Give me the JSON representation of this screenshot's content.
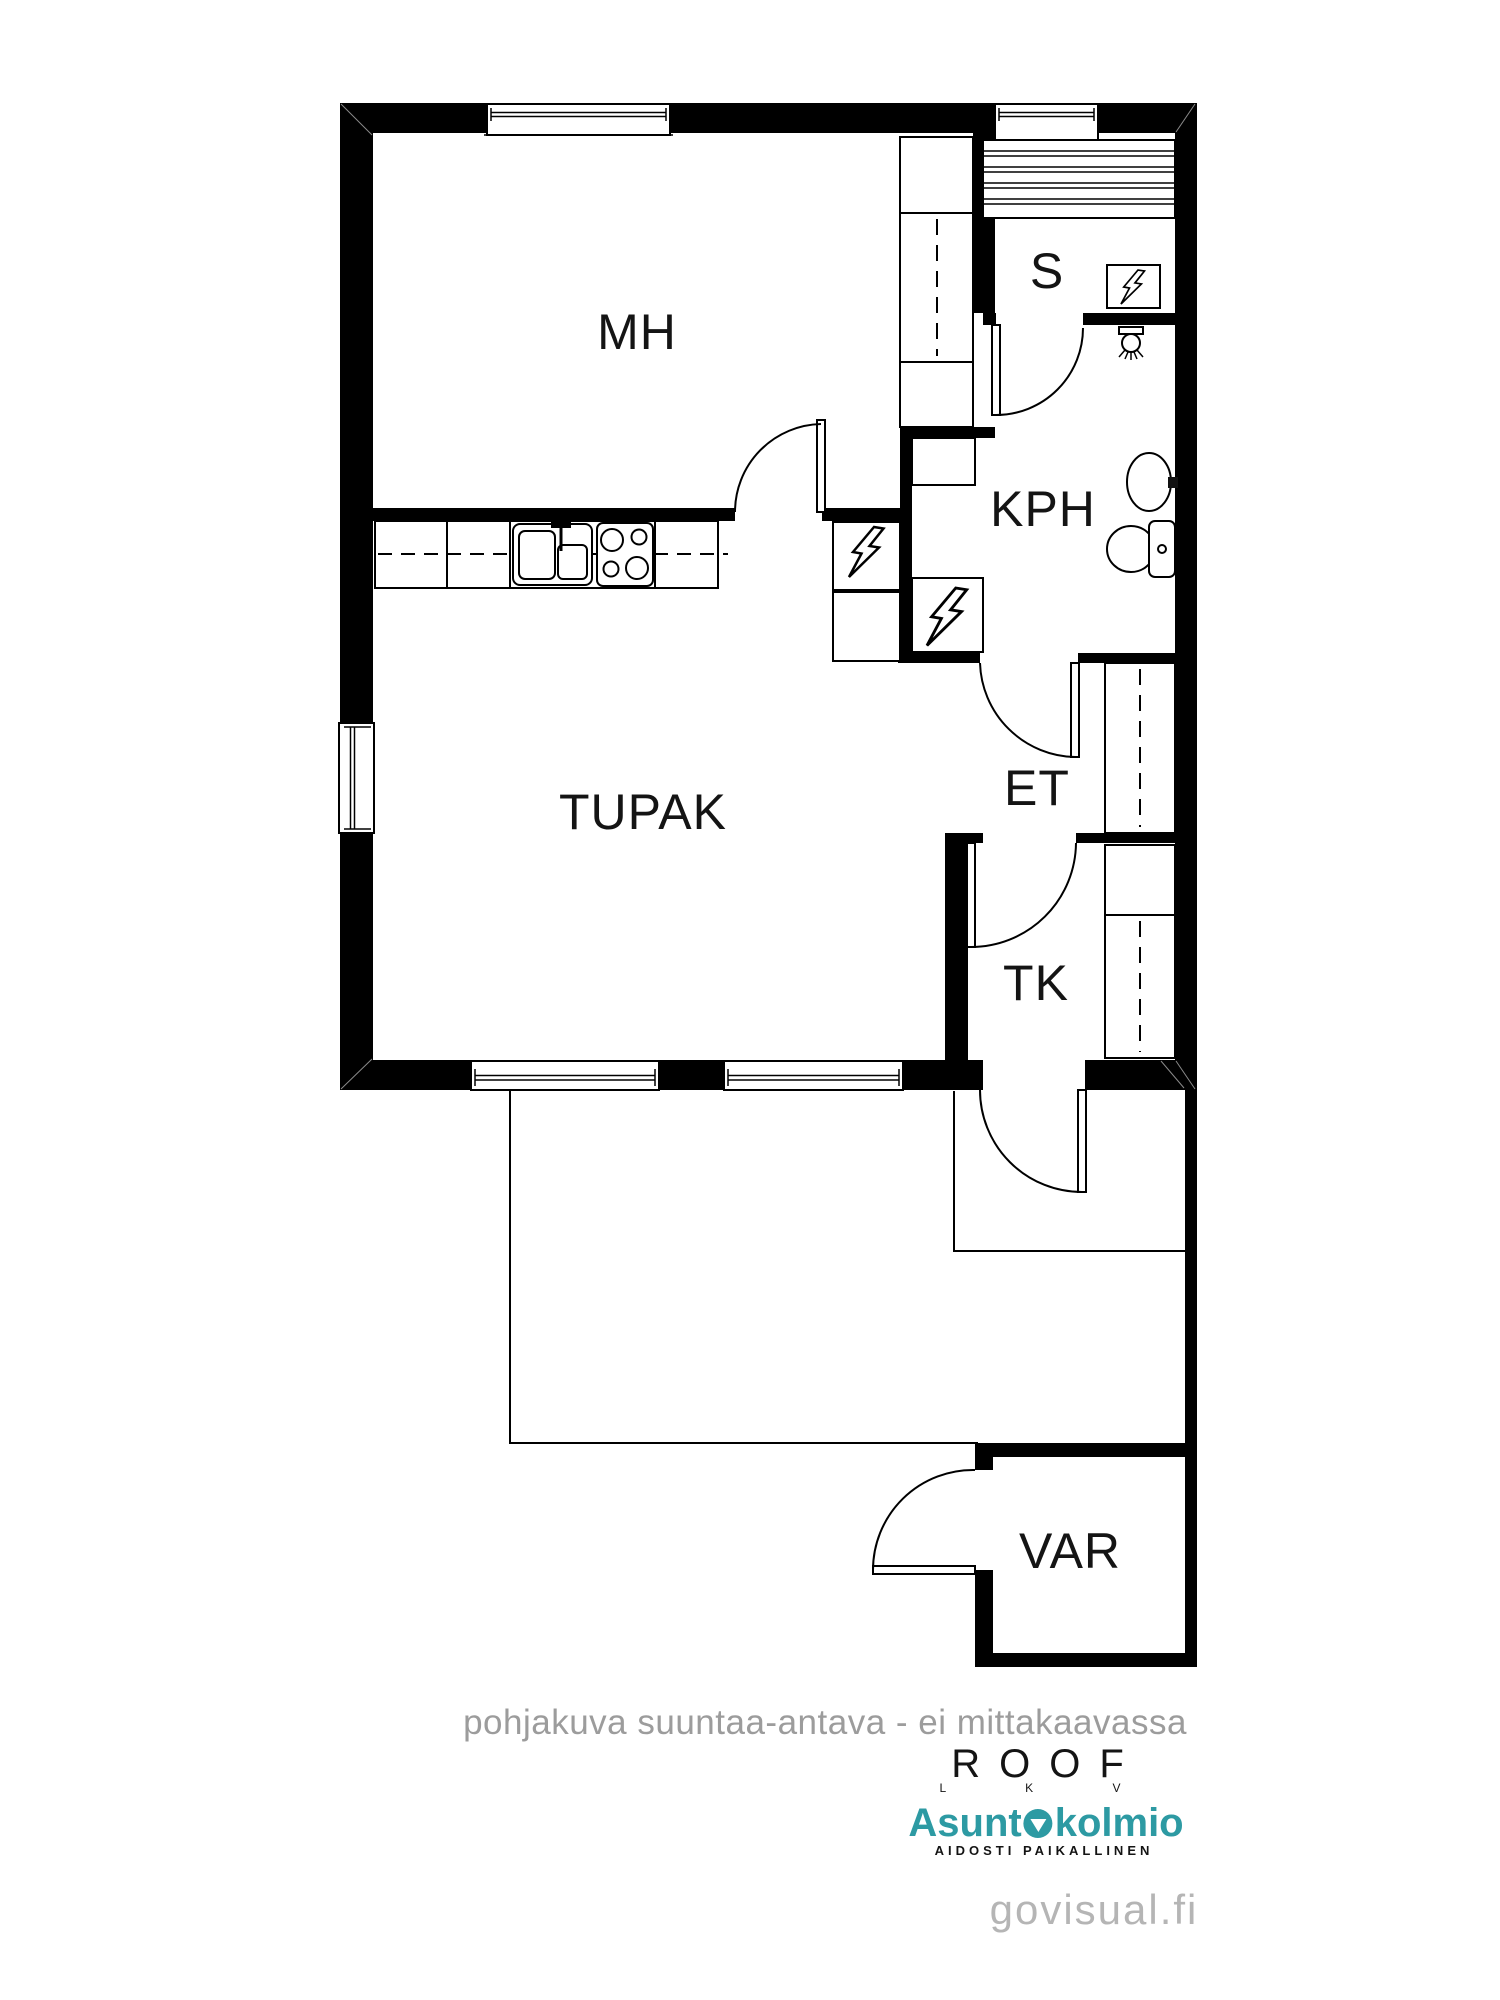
{
  "colors": {
    "wall_black": "#000000",
    "brand_teal": "#2d9aa3",
    "disclaimer_gray": "#9c9c9c",
    "watermark_gray": "#b5b5b5"
  },
  "plan": {
    "rooms": {
      "mh": "MH",
      "tupak": "TUPAK",
      "sauna": "S",
      "kph": "KPH",
      "et": "ET",
      "tk": "TK",
      "var": "VAR"
    },
    "symbols": {
      "electrical_box": "lightning-bolt-in-box",
      "sauna_heater": "lightning-bolt-in-box",
      "shower": "shower-head-with-spray",
      "washbasin": "oval-sink-with-tap",
      "toilet": "wc-bowl-and-cistern",
      "kitchen_sink": "double-basin-sink-with-tap",
      "stove": "four-burner-stove",
      "wardrobes": "dashed-line-sliding-door-closets",
      "sauna_benches": "horizontal-plank-hatching"
    }
  },
  "footer": {
    "disclaimer": "pohjakuva suuntaa-antava - ei mittakaavassa",
    "roof": {
      "name": "ROOF",
      "sub": "L K V"
    },
    "asuntokolmio": {
      "pre": "Asunt",
      "post": "kolmio",
      "tagline": "AIDOSTI PAIKALLINEN"
    },
    "watermark": "govisual.fi"
  }
}
